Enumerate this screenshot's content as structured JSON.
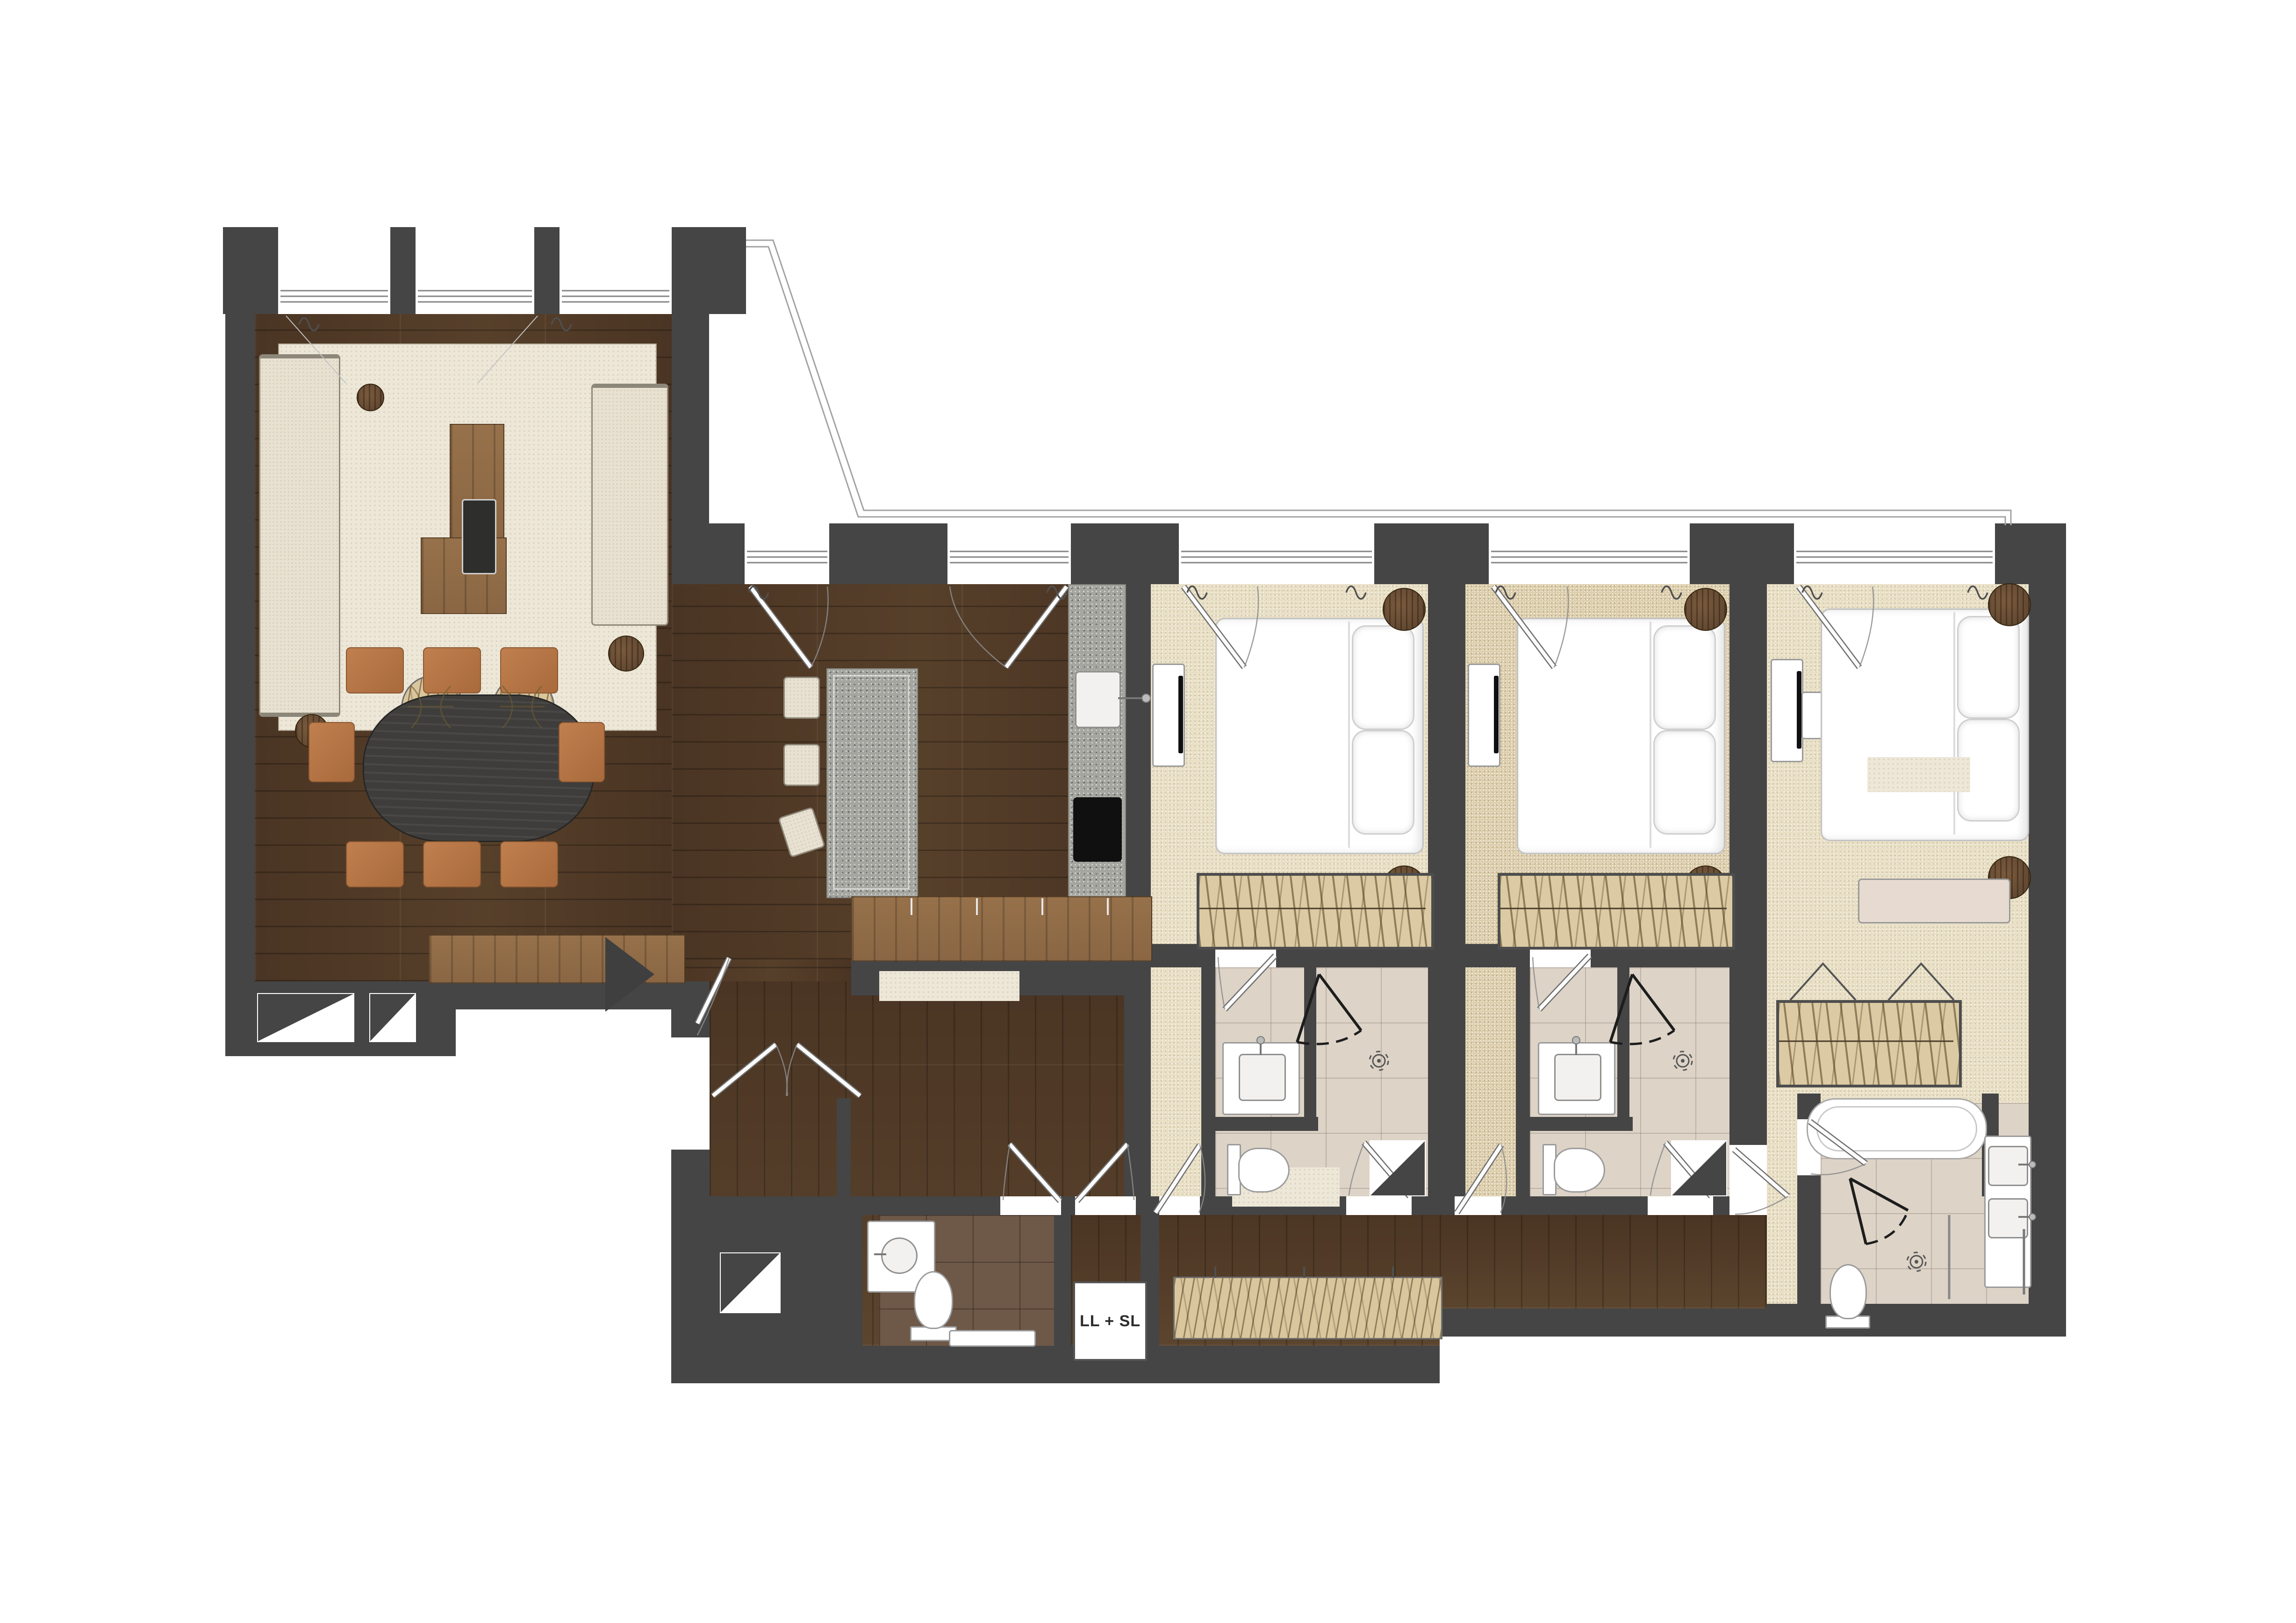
{
  "labels": {
    "laundry_closet": "LL + SL"
  },
  "colors": {
    "wall": "#454545",
    "wood_floor": "#4a3423",
    "wood_furniture": "#8a6644",
    "wood_dark": "#5a422e",
    "carpet": "#e8dfc5",
    "carpet_warm": "#ddcfae",
    "rug": "#ede7d8",
    "weave": "#d9c69c",
    "granite": "#a5a6a0",
    "tile_light": "#ddd3c7",
    "tile_dark": "#6e5847",
    "upholstery": "#e8e1d1",
    "chair": "#c07f4e",
    "table_top": "#3e3d3b",
    "fixture": "#ffffff",
    "line": "#8c8c8c",
    "terrace_line": "#a3a3a3",
    "bench_blush": "#e7dbd1"
  },
  "icons": {
    "entry_arrow": "filled-right-triangle",
    "door_swing": "door-leaf-with-quarter-arc",
    "shower_head": "target-rosette",
    "curtain": "wave-squiggle",
    "column_niche": "white-recess-with-dark-triangle",
    "window": "triple-glazing-lines"
  }
}
